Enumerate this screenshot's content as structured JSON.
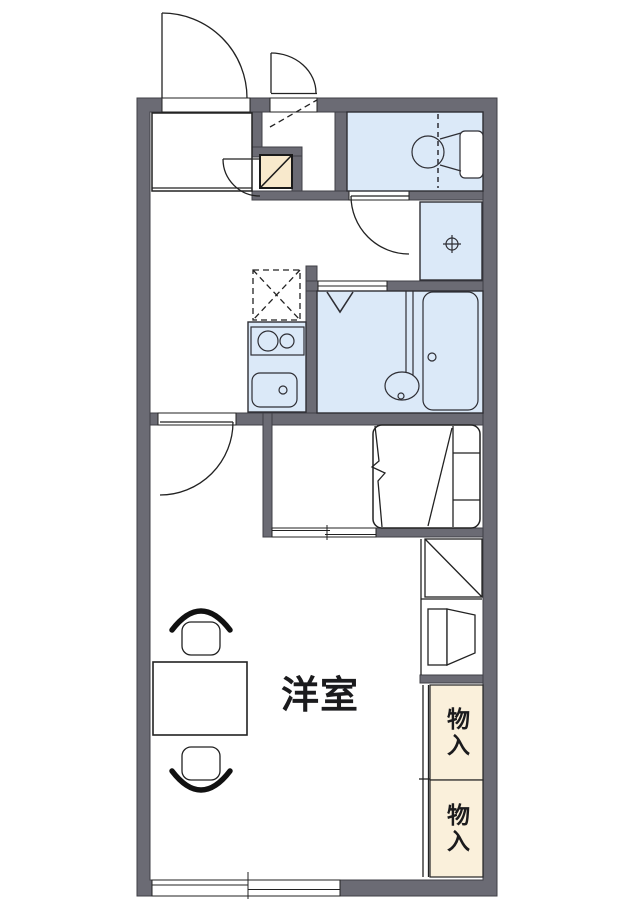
{
  "floorplan": {
    "labels": {
      "main_room": "洋室",
      "storage_upper": "物入",
      "storage_lower": "物入"
    },
    "colors": {
      "background": "#ffffff",
      "wall": "#6b6b74",
      "wall_outline": "#3f3f46",
      "water_area": "#dbe9f8",
      "storage_fill": "#faf0db",
      "shoe_cabinet_fill": "#f8e9cc",
      "line": "#222222",
      "label_text": "#1b1b1d"
    },
    "fixtures": [
      "entrance-door",
      "entry-door",
      "shoe-cabinet",
      "toilet",
      "washing-machine-pan",
      "refrigerator-space",
      "kitchen-counter",
      "stove-burners",
      "kitchen-sink",
      "bathtub",
      "wash-basin",
      "shower-symbol",
      "bed",
      "sliding-partition",
      "shelf-unit",
      "storage-closet",
      "table",
      "chair",
      "sliding-window"
    ]
  }
}
